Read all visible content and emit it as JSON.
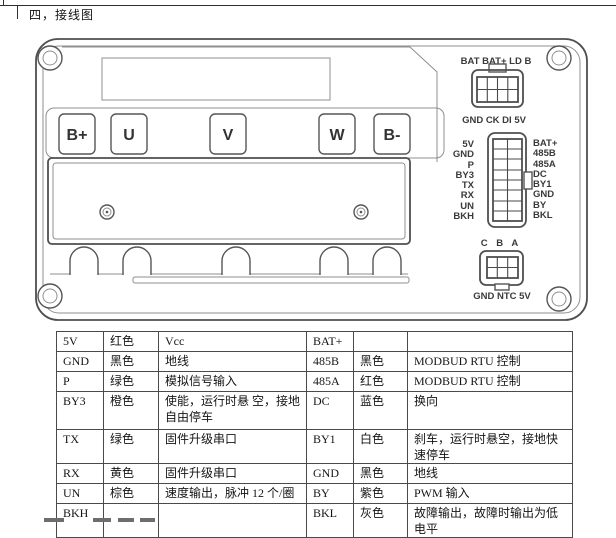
{
  "page": {
    "section_title": "四，接线图"
  },
  "diagram": {
    "terminals": [
      "B+",
      "U",
      "V",
      "W",
      "B-"
    ],
    "connector_top": {
      "label_top": "BAT BAT+ LD B",
      "label_bottom": "GND CK DI 5V"
    },
    "connector_mid": {
      "left_pins": [
        "5V",
        "GND",
        "P",
        "BY3",
        "TX",
        "RX",
        "UN",
        "BKH"
      ],
      "right_pins": [
        "BAT+",
        "485B",
        "485A",
        "DC",
        "BY1",
        "GND",
        "BY",
        "BKL"
      ]
    },
    "connector_bottom": {
      "label_top": "C  B  A",
      "label_bottom": "GND NTC 5V"
    }
  },
  "pin_table": {
    "rows": [
      {
        "pin_l": "5V",
        "color_l": "红色",
        "desc_l": "Vcc",
        "pin_r": "BAT+",
        "color_r": "",
        "desc_r": ""
      },
      {
        "pin_l": "GND",
        "color_l": "黑色",
        "desc_l": "地线",
        "pin_r": "485B",
        "color_r": "黑色",
        "desc_r": "MODBUD RTU 控制"
      },
      {
        "pin_l": "P",
        "color_l": "绿色",
        "desc_l": "模拟信号输入",
        "pin_r": "485A",
        "color_r": "红色",
        "desc_r": "MODBUD RTU 控制"
      },
      {
        "pin_l": "BY3",
        "color_l": "橙色",
        "desc_l": "使能，运行时悬 空，接地自由停车",
        "pin_r": "DC",
        "color_r": "蓝色",
        "desc_r": "换向"
      },
      {
        "pin_l": "TX",
        "color_l": "绿色",
        "desc_l": "固件升级串口",
        "pin_r": "BY1",
        "color_r": "白色",
        "desc_r": "刹车，运行时悬空，接地快速停车"
      },
      {
        "pin_l": "RX",
        "color_l": "黄色",
        "desc_l": "固件升级串口",
        "pin_r": "GND",
        "color_r": "黑色",
        "desc_r": "地线"
      },
      {
        "pin_l": "UN",
        "color_l": "棕色",
        "desc_l": "速度输出，脉冲 12 个/圈",
        "pin_r": "BY",
        "color_r": "紫色",
        "desc_r": "PWM 输入"
      },
      {
        "pin_l": "BKH",
        "color_l": "",
        "desc_l": "",
        "pin_r": "BKL",
        "color_r": "灰色",
        "desc_r": "故障输出，故障时输出为低电平"
      }
    ]
  },
  "colors": {
    "pin_red": "#e03131",
    "line_dark": "#4a4a4a",
    "line_light": "#8f8f8f",
    "background": "#ffffff"
  }
}
